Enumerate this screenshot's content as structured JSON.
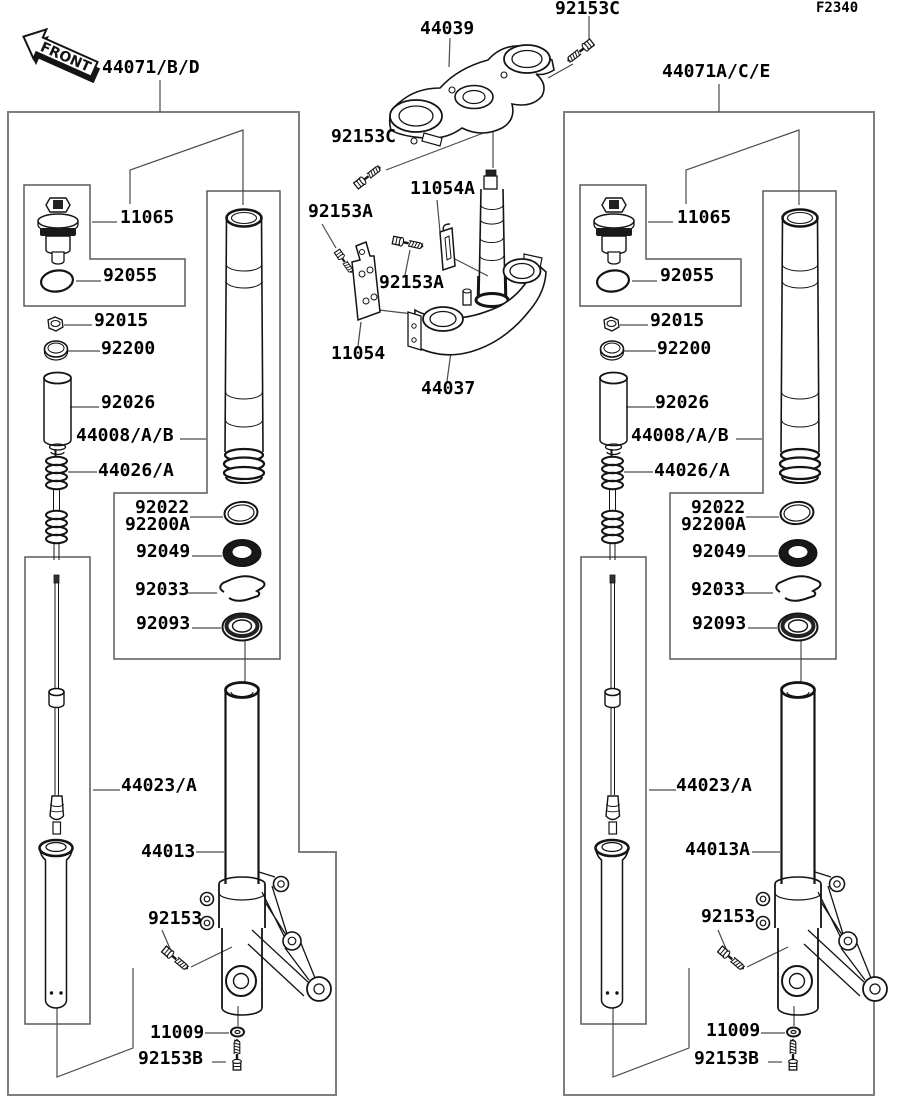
{
  "figure": {
    "code": "F2340",
    "front_label": "FRONT"
  },
  "assemblies": {
    "left": "44071/B/D",
    "right": "44071A/C/E"
  },
  "center": {
    "top_clamp": "44039",
    "top_clamp_bolt": "92153C",
    "side_bolt": "92153C",
    "clamp_bracket_a": "11054A",
    "bracket_bolt_1": "92153A",
    "bracket_bolt_2": "92153A",
    "clamp_bracket": "11054",
    "bottom_clamp": "44037"
  },
  "left": {
    "fork_cap": "11065",
    "o_ring": "92055",
    "nut": "92015",
    "ring": "92200",
    "collar": "92026",
    "inner_tube": "44008/A/B",
    "spring": "44026/A",
    "ring_92022": "92022",
    "ring_92200a": "92200A",
    "oil_seal": "92049",
    "stop_ring": "92033",
    "dust_seal": "92093",
    "damper_assy": "44023/A",
    "outer_tube": "44013",
    "bolt_92153": "92153",
    "washer": "11009",
    "bolt_92153b": "92153B"
  },
  "right": {
    "fork_cap": "11065",
    "o_ring": "92055",
    "nut": "92015",
    "ring": "92200",
    "collar": "92026",
    "inner_tube": "44008/A/B",
    "spring": "44026/A",
    "ring_92022": "92022",
    "ring_92200a": "92200A",
    "oil_seal": "92049",
    "stop_ring": "92033",
    "dust_seal": "92093",
    "damper_assy": "44023/A",
    "outer_tube": "44013A",
    "bolt_92153": "92153",
    "washer": "11009",
    "bolt_92153b": "92153B"
  },
  "colors": {
    "background": "#ffffff",
    "line": "#141414",
    "box_outline": "#7f7f7f",
    "label_text": "#000000"
  }
}
